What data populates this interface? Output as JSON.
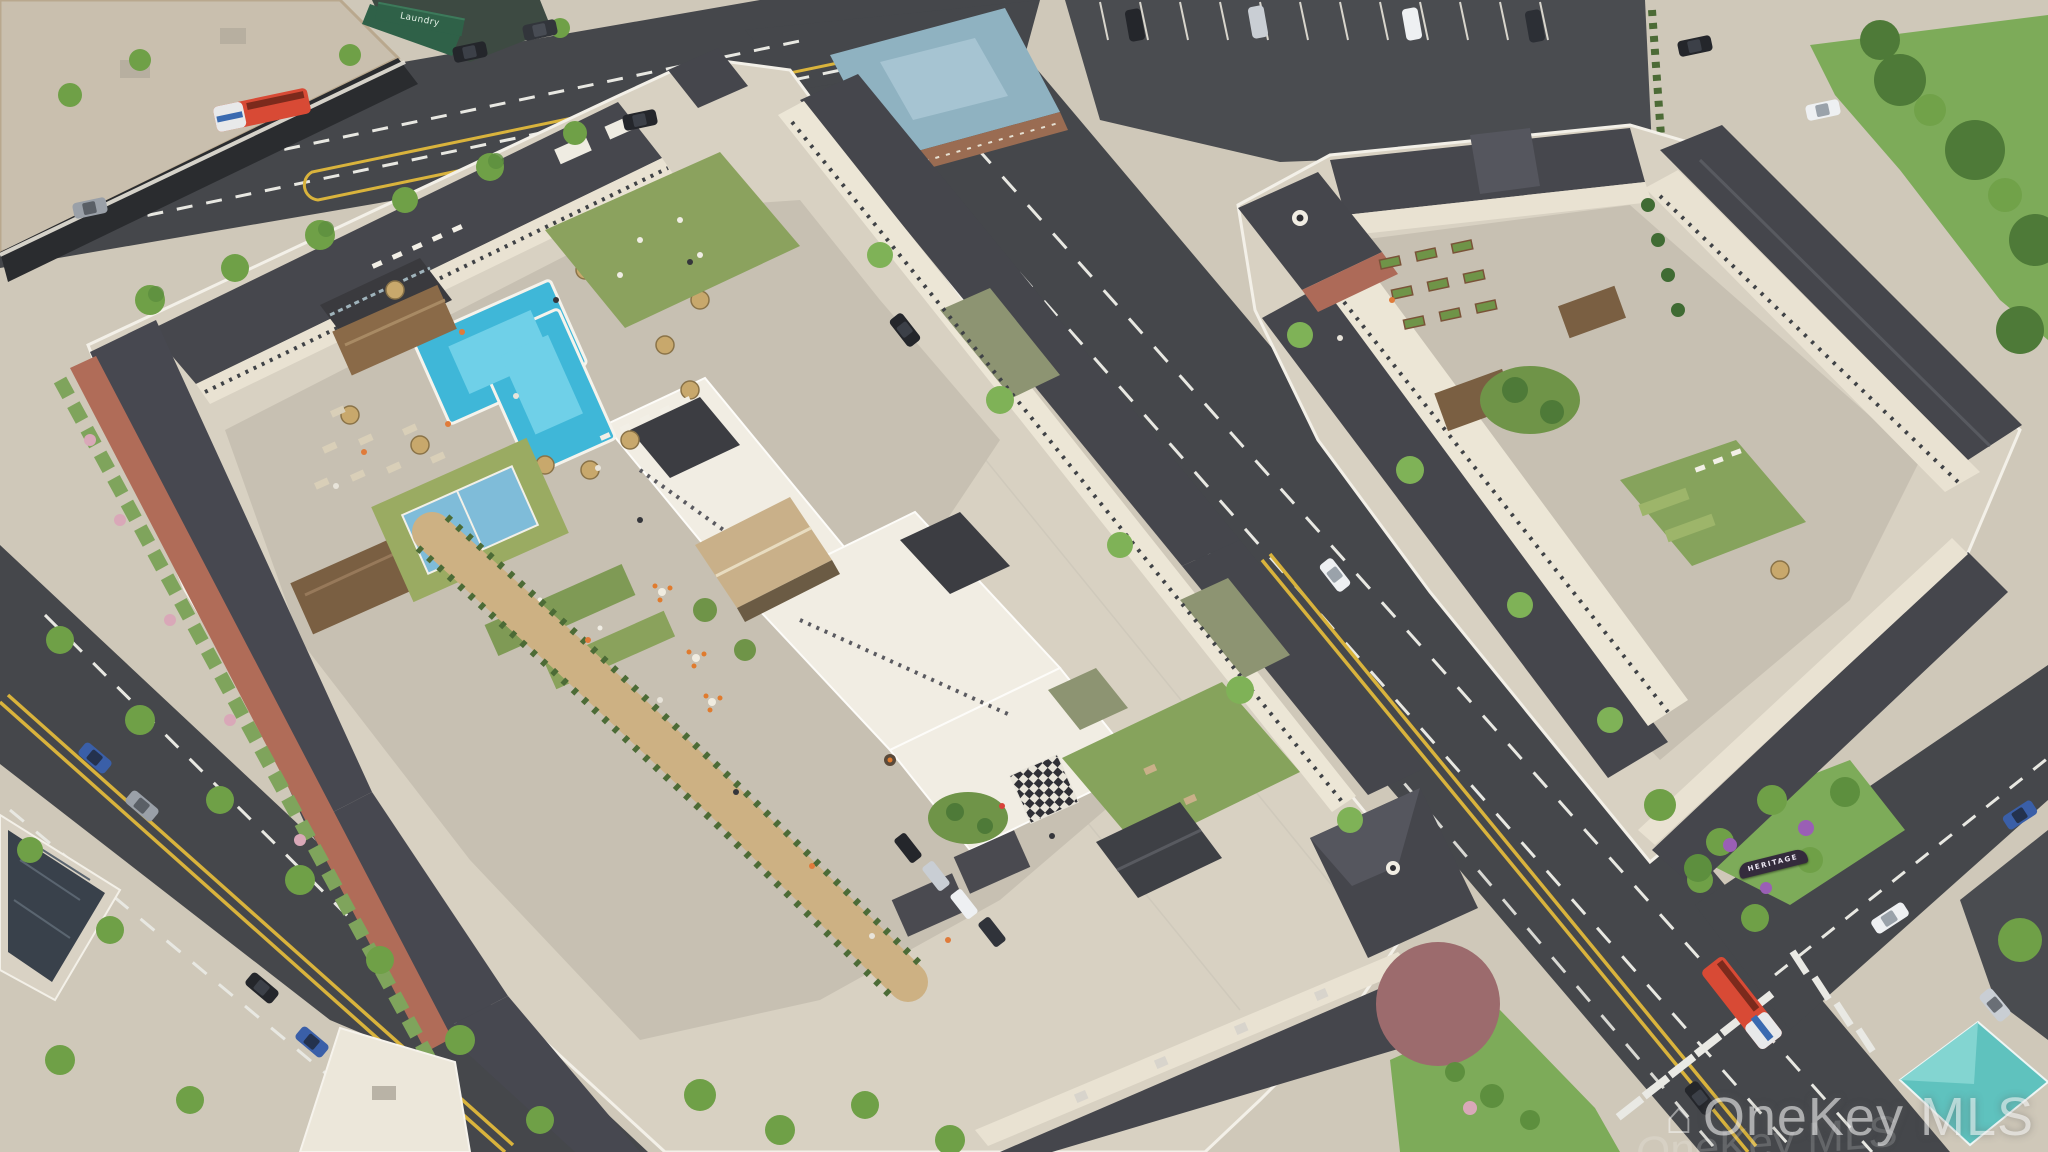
{
  "image": {
    "kind": "aerial 3D architectural rendering",
    "subject": "apartment community with rooftop courtyard amenity decks",
    "development_name": "Heritage"
  },
  "watermark": {
    "logo_icon": "house-icon",
    "text": "OneKey MLS",
    "echo_text": "OneKey MLS"
  },
  "signs": {
    "monument_sign": "HERITAGE",
    "storefront_sign": "Laundry"
  },
  "scene": {
    "amenities": [
      "swimming pool",
      "pool cabana",
      "pergolas",
      "sport court",
      "mini golf",
      "turf lawn",
      "outdoor dining terrace",
      "giant chess board",
      "community garden beds",
      "courtyard lawn games"
    ],
    "context": [
      "city streets with buses and cars",
      "street trees",
      "surface parking lot",
      "retail strip",
      "monument sign with purple plantings",
      "teal corner pavilion",
      "solar panel roof"
    ],
    "palette": {
      "asphalt": "#45474b",
      "sidewalk": "#cfc8b9",
      "podium_pavers": "#d8d1c2",
      "courtyard_pavers": "#c7c0b2",
      "pool_water": "#3fb7d8",
      "turf_green": "#8aa25e",
      "court_blue": "#7fbcd9",
      "roof_dark": "#45464c",
      "wall_cream": "#e9e2d2",
      "wall_olive": "#8d9472",
      "brick_red": "#ad6a58",
      "hip_roof_blue": "#8fb2c1",
      "pavilion_teal": "#5fc2be",
      "bus_red": "#d84a35",
      "lane_yellow": "#d9b33c",
      "tree_green": "#6fa047",
      "patio_maroon": "#9c6b6d",
      "walkway_tan": "#cdb183"
    }
  }
}
